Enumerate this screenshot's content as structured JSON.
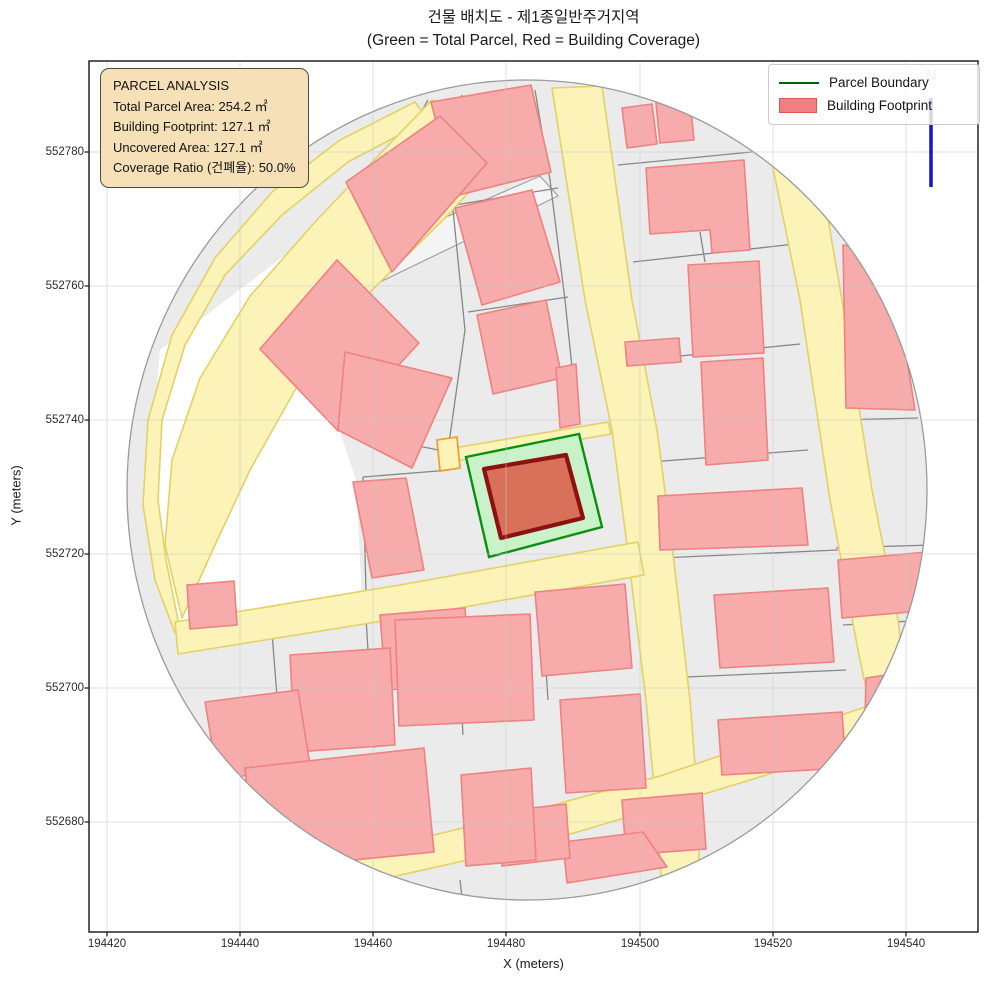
{
  "figure": {
    "title_line1": "건물 배치도 - 제1종일반주거지역",
    "title_line2": "(Green = Total Parcel, Red = Building Coverage)"
  },
  "axes": {
    "xlabel": "X (meters)",
    "ylabel": "Y (meters)",
    "xticks": [
      {
        "label": "194420",
        "px": 107
      },
      {
        "label": "194440",
        "px": 240
      },
      {
        "label": "194460",
        "px": 373
      },
      {
        "label": "194480",
        "px": 506
      },
      {
        "label": "194500",
        "px": 640
      },
      {
        "label": "194520",
        "px": 773
      },
      {
        "label": "194540",
        "px": 906
      }
    ],
    "yticks": [
      {
        "label": "552780",
        "py": 152
      },
      {
        "label": "552760",
        "py": 286
      },
      {
        "label": "552740",
        "py": 420
      },
      {
        "label": "552720",
        "py": 554
      },
      {
        "label": "552700",
        "py": 688
      },
      {
        "label": "552680",
        "py": 822
      }
    ],
    "frame": {
      "left": 89,
      "top": 61,
      "right": 978,
      "bottom": 932
    }
  },
  "legend": {
    "items": [
      {
        "label": "Parcel Boundary",
        "type": "line",
        "color": "#006400"
      },
      {
        "label": "Building Footprint",
        "type": "patch",
        "fill": "#f08080",
        "stroke": "#e05555"
      }
    ]
  },
  "info_box": {
    "lines": [
      "PARCEL ANALYSIS",
      "Total Parcel Area: 254.2 ㎡",
      "Building Footprint: 127.1 ㎡",
      "Uncovered Area: 127.1 ㎡",
      "Coverage Ratio (건폐율): 50.0%"
    ],
    "bg": "#f5deb3"
  },
  "north_arrow": {
    "label": "N",
    "color": "#1414cc",
    "label_color": "#b6bdf0"
  },
  "chart_data": {
    "type": "map",
    "title": "건물 배치도 - 제1종일반주거지역 (Green = Total Parcel, Red = Building Coverage)",
    "zone": "제1종일반주거지역",
    "total_parcel_area_m2": 254.2,
    "building_footprint_m2": 127.1,
    "uncovered_area_m2": 127.1,
    "coverage_ratio_pct": 50.0,
    "xlabel": "X (meters)",
    "ylabel": "Y (meters)",
    "xlim": [
      194417,
      194550
    ],
    "ylim": [
      552664,
      552794
    ],
    "xticks": [
      194420,
      194440,
      194460,
      194480,
      194500,
      194520,
      194540
    ],
    "yticks": [
      552680,
      552700,
      552720,
      552740,
      552760,
      552780
    ],
    "legend": [
      "Parcel Boundary",
      "Building Footprint"
    ],
    "grid": true,
    "legend_position": "upper right"
  },
  "map": {
    "colors": {
      "base": "#ebebeb",
      "rim": "#9b9b9b",
      "white": "#ffffff",
      "road_fill": "#fbf3b8",
      "road_stroke": "#e3d165",
      "building_fill": "#f7abab",
      "building_stroke": "#ee8181",
      "parcel_line": "#878787",
      "green_fill": "#c9f2c9",
      "green_stroke": "#0a9010",
      "red_fill": "#d9705a",
      "red_stroke": "#8e1111",
      "grid": "#c9c9c9",
      "accent": "#f0a030"
    },
    "ellipse": {
      "cx": 527,
      "cy": 490,
      "rx": 400,
      "ry": 410
    },
    "white_areas": [
      "160,350 250,282 340,212 428,150 452,172 355,242 268,345 340,432 356,480 362,600 250,622 178,632 163,540 152,440"
    ],
    "slivers": [
      "352,258 540,176 558,196 380,282 356,272"
    ],
    "parcel_lines": [
      "428,100 340,258 262,348",
      "350,255 460,200",
      "462,95 452,200 465,330 448,450",
      "535,90 550,180 565,300 578,425",
      "455,205 558,188",
      "468,312 568,297",
      "340,430 448,452",
      "363,477 366,592",
      "363,477 450,470",
      "618,165 772,150",
      "633,262 795,244",
      "640,360 800,344",
      "650,462 808,450",
      "700,232 705,262",
      "838,420 918,418",
      "836,548 930,545",
      "843,625 928,620",
      "660,558 838,550",
      "664,678 846,670",
      "272,632 282,762",
      "365,602 374,748",
      "455,590 463,735",
      "540,578 548,700",
      "460,880 466,932",
      "300,770 306,878"
    ],
    "roads": [
      "415,102 340,140 272,192 215,258 172,335 148,420 143,505 155,580 175,633 178,620 166,560 158,500 162,420 185,345 225,275 282,215 348,162 428,120",
      "432,100 522,134 448,215 362,300 295,390 250,470 215,545 182,618 165,545 172,460 200,378 250,296 315,222 372,162",
      "552,88 602,86 632,300 657,430 672,545 690,700 700,830 697,893 662,890 658,830 646,700 627,545 612,430 585,300",
      "758,95 806,92 842,300 872,490 898,620 908,700 884,775 858,650 830,500 800,300",
      "175,622 400,585 638,542 644,575 420,615 178,654",
      "340,858 520,814 660,776 886,700 900,734 665,806 530,846 352,886",
      "442,450 608,422 611,434 444,463"
    ],
    "road_accents": [
      "437,440 457,437 460,468 440,471"
    ],
    "buildings": [
      "431,102 531,85 551,172 455,196",
      "455,208 532,190 560,282 482,305",
      "477,315 546,300 562,378 493,394",
      "346,182 440,116 487,163 392,272",
      "337,260 260,349 338,431 419,343",
      "345,352 452,378 412,468 338,430",
      "353,482 406,478 424,570 372,578",
      "646,168 744,160 750,250 712,253 710,230 650,234",
      "625,342 679,338 681,362 627,366",
      "688,265 759,261 764,353 693,357",
      "701,362 763,358 768,460 706,465",
      "622,108 652,104 657,144 627,148",
      "656,103 690,100 694,140 660,143",
      "843,245 890,253 915,410 846,408",
      "838,560 928,552 932,610 842,618",
      "866,678 906,672 900,762 864,760",
      "658,496 802,488 808,545 660,550",
      "714,595 828,588 834,662 720,668",
      "718,720 842,712 846,768 722,775",
      "560,700 640,694 646,788 566,793",
      "622,800 702,793 706,849 626,855",
      "563,842 643,832 667,867 567,883",
      "498,812 566,804 570,858 502,866",
      "187,585 234,581 237,625 190,629",
      "380,615 465,608 470,684 386,690",
      "290,655 390,648 395,745 295,752",
      "205,702 298,690 310,765 218,780",
      "245,768 424,748 434,852 255,870",
      "395,620 530,614 534,720 399,726",
      "461,775 531,768 536,860 466,866",
      "535,592 625,584 632,668 542,676",
      "556,368 576,364 580,424 560,428"
    ],
    "parcel_highlight": "466,457 579,434 602,527 489,557",
    "building_highlight": "484,469 566,455 583,518 501,538",
    "north_line": {
      "x": 931,
      "y1": 187,
      "y2": 98
    },
    "north_label_pos": {
      "x": 931,
      "y": 80
    }
  }
}
